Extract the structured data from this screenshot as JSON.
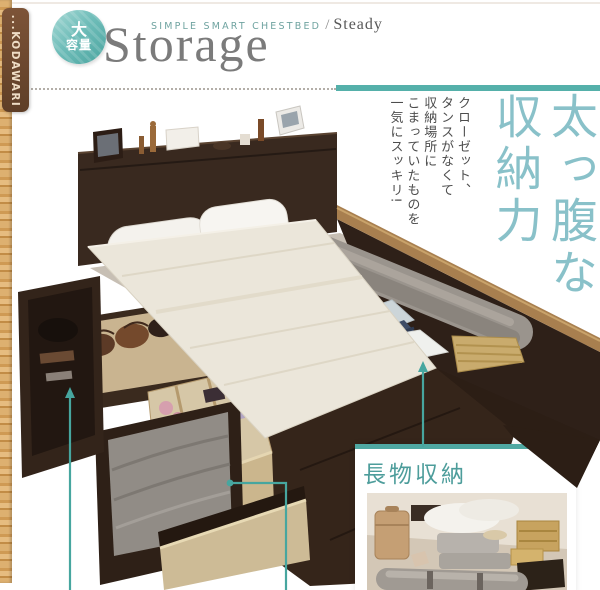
{
  "side_tab": {
    "label": "...KODAWARI"
  },
  "header": {
    "badge": {
      "line1": "大",
      "line2": "容量"
    },
    "series_label": "SIMPLE SMART CHESTBED",
    "series_sep": "/",
    "series_name": "Steady",
    "product_title": "Storage"
  },
  "catch": {
    "headline_col1": "太っ腹な",
    "headline_col2": "収納力",
    "sub_lines": [
      "クローゼット、",
      "タンスがなくて",
      "収納場所に",
      "こまっていたものを",
      "一気にスッキリ!"
    ]
  },
  "callout": {
    "title": "長物収納"
  },
  "icons": {
    "up_arrow": "▲",
    "leader_dot": "●"
  },
  "colors": {
    "teal_accent": "#55b0aa",
    "headline_teal": "#89c1c9",
    "callout_text": "#4d9d9b",
    "tab_brown": "#6b4631",
    "wood_strip": "#d8a761",
    "frame_dark": "#33241b",
    "board_wood": "#ebe6da",
    "drawer_wood": "#cdbb96"
  }
}
